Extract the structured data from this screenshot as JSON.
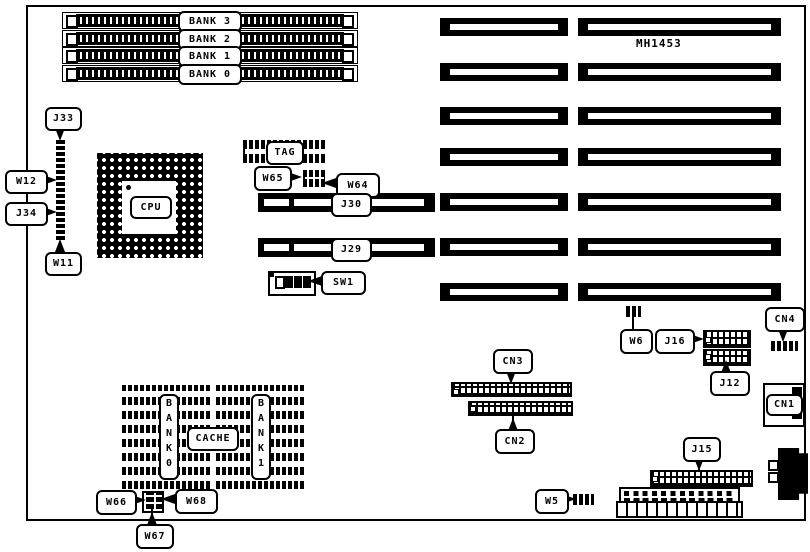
{
  "diagram": {
    "board_model": "MH1453",
    "memory_banks": [
      "BANK 3",
      "BANK 2",
      "BANK 1",
      "BANK 0"
    ],
    "cpu_label": "CPU",
    "tag_label": "TAG",
    "cache": {
      "title": "CACHE",
      "bank0_vertical": "B\nA\nN\nK\n0",
      "bank1_vertical": "B\nA\nN\nK\n1"
    },
    "slot_labels": {
      "j30": "J30",
      "j29": "J29"
    },
    "component_labels": {
      "j33": "J33",
      "w12": "W12",
      "j34": "J34",
      "w11": "W11",
      "w65": "W65",
      "w64": "W64",
      "sw1": "SW1",
      "w6": "W6",
      "j16": "J16",
      "j12": "J12",
      "cn4": "CN4",
      "cn1": "CN1",
      "cn3": "CN3",
      "cn2": "CN2",
      "j15": "J15",
      "w5": "W5",
      "w66": "W66",
      "w67": "W67",
      "w68": "W68"
    }
  }
}
